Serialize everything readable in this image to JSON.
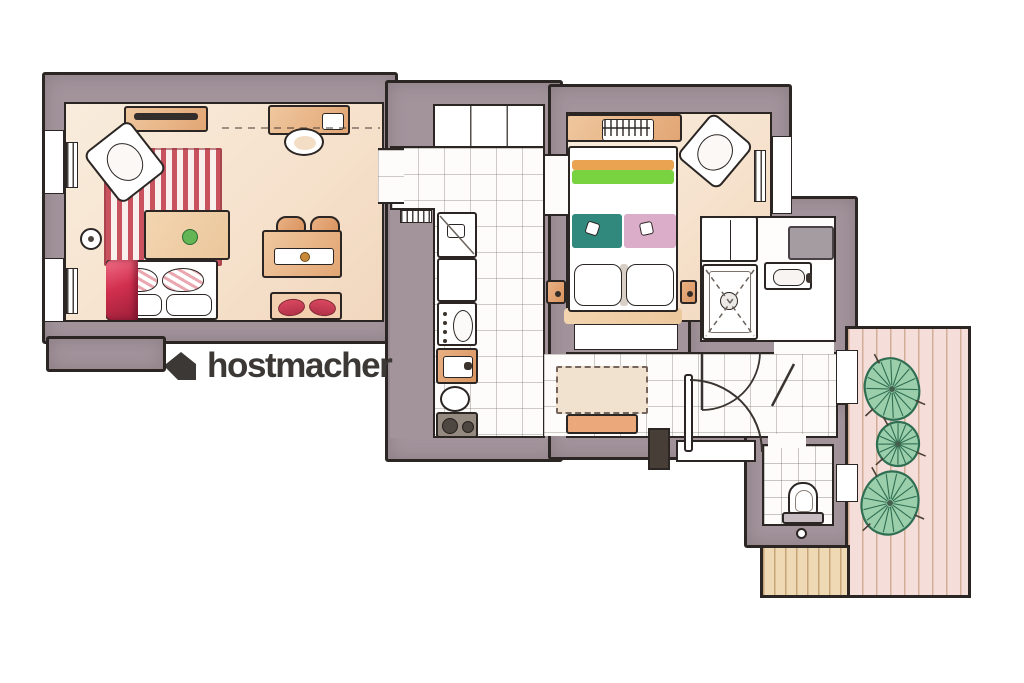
{
  "logo": {
    "text": "hostmacher",
    "icon": "house-icon"
  },
  "palette": {
    "ink": "#2b2624",
    "wall": "#a3949c",
    "floor_warm": "#f7e6d2",
    "tile_line": "#b9b0ab",
    "rug_red": "#c8525e",
    "accent_red": "#d2455c",
    "accent_pink": "#eba7b0",
    "stripe_orange": "#eaa351",
    "stripe_green": "#79d341",
    "blanket_teal": "#31897d",
    "blanket_pink": "#dcadc9",
    "wood": "#e8b389",
    "deck": "#f5ded9",
    "deck_line": "#c49b72",
    "plant": "#9bcfab",
    "plant_line": "#2f6e52",
    "logo_color": "#3b3835"
  },
  "legend": {
    "icons": [
      "house-icon",
      "tv-sideboard",
      "desk",
      "desk-chair",
      "armchair",
      "striped-rug",
      "coffee-table",
      "plant",
      "sofa",
      "red-throw",
      "dining-table",
      "dining-chair",
      "dining-bench",
      "radiator",
      "window",
      "fridge",
      "kitchen-sink",
      "oven",
      "stove",
      "wardrobe",
      "double-bed",
      "nightstand",
      "shower",
      "bathroom-sink",
      "washing-machine",
      "toilet",
      "entry-door",
      "hall-rug",
      "hall-bench",
      "terrace-plant",
      "wood-deck"
    ]
  }
}
